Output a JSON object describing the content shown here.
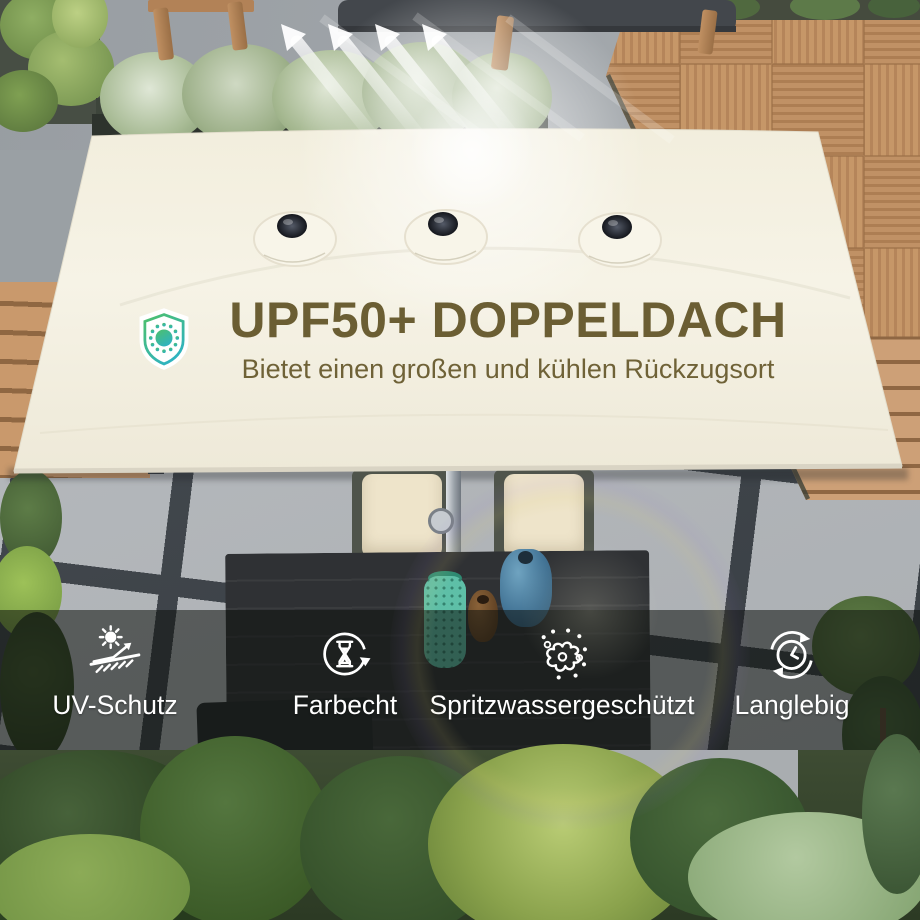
{
  "hero": {
    "badge_icon": "sun-shield-icon",
    "title": "UPF50+ DOPPELDACH",
    "subtitle": "Bietet einen großen und kühlen Rückzugsort"
  },
  "features": [
    {
      "icon": "uv-reflection-icon",
      "label": "UV-Schutz"
    },
    {
      "icon": "hourglass-refresh-icon",
      "label": "Farbecht"
    },
    {
      "icon": "water-splash-icon",
      "label": "Spritzwassergeschützt"
    },
    {
      "icon": "clock-longevity-icon",
      "label": "Langlebig"
    }
  ],
  "colors": {
    "title_text": "#6b5e33",
    "canopy_cream": "#f5f1e2",
    "feature_text": "#ffffff",
    "band_overlay": "rgba(14,18,14,0.55)",
    "badge_green": "#4ec06a",
    "badge_teal": "#2fb3c0",
    "arrow_white": "#ffffff"
  }
}
